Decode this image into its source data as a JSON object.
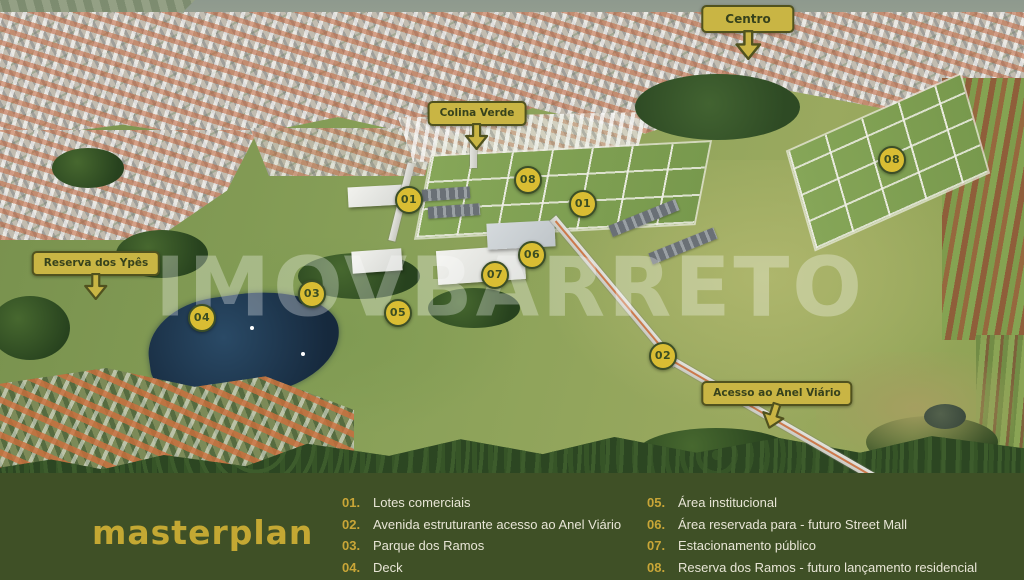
{
  "watermark": {
    "text": "IMOVBARRETO"
  },
  "brand": {
    "logo": "masterplan"
  },
  "map": {
    "callouts": [
      {
        "id": "centro",
        "label": "Centro"
      },
      {
        "id": "colina-verde",
        "label": "Colina Verde"
      },
      {
        "id": "reserva-dos-ypes",
        "label": "Reserva dos Ypês"
      },
      {
        "id": "acesso-anel-viario",
        "label": "Acesso ao Anel Viário"
      }
    ],
    "markers": [
      {
        "label": "01"
      },
      {
        "label": "01"
      },
      {
        "label": "08"
      },
      {
        "label": "08"
      },
      {
        "label": "06"
      },
      {
        "label": "07"
      },
      {
        "label": "03"
      },
      {
        "label": "05"
      },
      {
        "label": "04"
      },
      {
        "label": "02"
      }
    ]
  },
  "legend": {
    "items": [
      {
        "num": "01.",
        "text": "Lotes comerciais"
      },
      {
        "num": "02.",
        "text": "Avenida estruturante acesso ao Anel Viário"
      },
      {
        "num": "03.",
        "text": "Parque dos Ramos"
      },
      {
        "num": "04.",
        "text": "Deck"
      },
      {
        "num": "05.",
        "text": "Área institucional"
      },
      {
        "num": "06.",
        "text": "Área reservada para - futuro Street Mall"
      },
      {
        "num": "07.",
        "text": "Estacionamento público"
      },
      {
        "num": "08.",
        "text": "Reserva dos Ramos - futuro lançamento residencial"
      }
    ]
  },
  "colors": {
    "callout_yellow": "#c9b544",
    "marker_yellow": "#d9bd33",
    "dark_olive_green": "#3f5026",
    "legend_number_gold": "#c9a637",
    "legend_text_cream": "#e8e5d6",
    "logo_gold": "#c4a833"
  }
}
